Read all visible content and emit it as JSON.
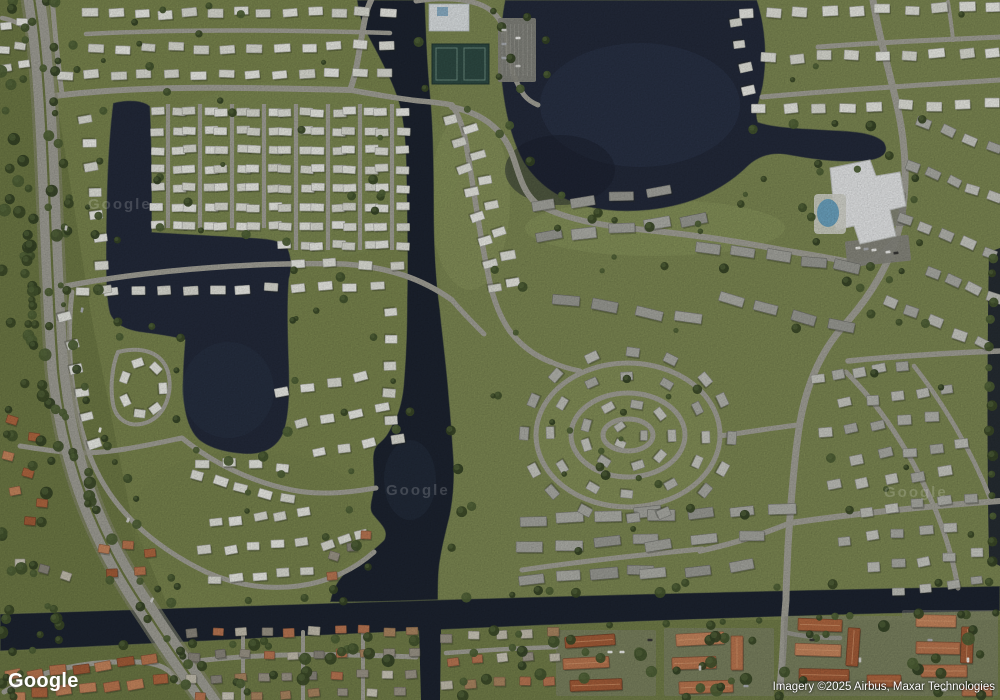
{
  "map": {
    "type": "satellite-imagery",
    "watermark_logo": "Google",
    "tile_watermark": "Google",
    "attribution": "Imagery ©2025 Airbus, Maxar Technologies"
  },
  "palette": {
    "grass_base": "#7d8950",
    "grass_bright": "#85915a",
    "grass_dark": "#6e7a45",
    "grass_pale": "#93a063",
    "water_lake": "#242b3c",
    "water_canal": "#1d2431",
    "water_highlight": "#36415c",
    "water_shadow": "#1a1f2c",
    "shoreline": "#7d8a55",
    "road": "#a7a69c",
    "highway": "#a5a49b",
    "highway_shoulder": "#8e9077",
    "median_green": "#6d7944",
    "parking": "#8b8b83",
    "roof_white": [
      "#f0f1ea",
      "#e9eae2",
      "#f4f5ef",
      "#e2e3da"
    ],
    "roof_gray": [
      "#c6c7c0",
      "#babbb4",
      "#cfd0c9",
      "#b0b1aa"
    ],
    "roof_condo": [
      "#aaaba4",
      "#9fa099",
      "#b4b5ae"
    ],
    "roof_orange": [
      "#c07a52",
      "#b56a42",
      "#cd8a60",
      "#a85f3a"
    ],
    "roof_mixed": [
      "#c9c4b4",
      "#b08a64",
      "#a09a8c",
      "#8f8b80",
      "#bf7a55",
      "#d3cfc0"
    ],
    "tree": [
      "#3c4b28",
      "#44552e",
      "#4f6136",
      "#364526"
    ],
    "tree_light": "#5d6f41",
    "pool_water": "#6fa8c6",
    "tennis_court": "#2f4c45",
    "court_line": "#6c8d80",
    "building_white": "#edeff0",
    "building_facility": "#e3e8ea",
    "building_blue_roof": "#8fb4cc",
    "car": [
      "#f5f5f2",
      "#d8d8d4",
      "#3a3a38",
      "#b0b3b8"
    ],
    "shadow": "#272b20"
  }
}
